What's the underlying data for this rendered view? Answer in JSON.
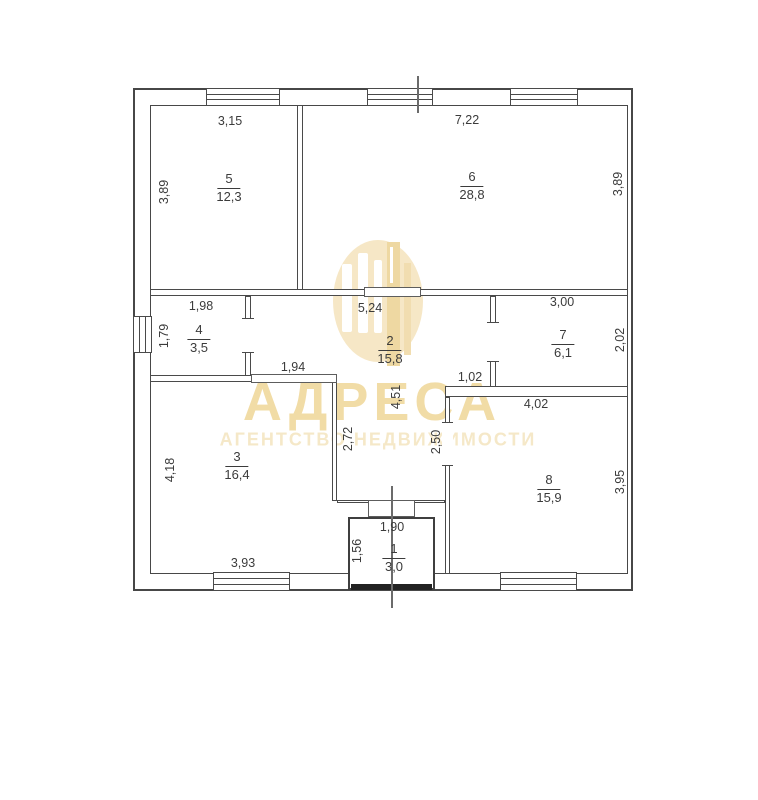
{
  "watermark": {
    "brand": "АДРЕСА",
    "tagline": "АГЕНТСТВО НЕДВИЖИМОСТИ",
    "brand_color": "#f1dca6",
    "tagline_color": "#f5e8c8",
    "logo_color": "#f6e7c6"
  },
  "colors": {
    "line": "#4a4a4a",
    "label": "#3b3b3b",
    "entrance_door": "#222222",
    "background": "#ffffff"
  },
  "rooms": {
    "r1": {
      "number": "1",
      "area": "3,0"
    },
    "r2": {
      "number": "2",
      "area": "15,8"
    },
    "r3": {
      "number": "3",
      "area": "16,4"
    },
    "r4": {
      "number": "4",
      "area": "3,5"
    },
    "r5": {
      "number": "5",
      "area": "12,3"
    },
    "r6": {
      "number": "6",
      "area": "28,8"
    },
    "r7": {
      "number": "7",
      "area": "6,1"
    },
    "r8": {
      "number": "8",
      "area": "15,9"
    }
  },
  "dims": {
    "room5_top": "3,15",
    "room6_top": "7,22",
    "room5_left": "3,89",
    "room6_right": "3,89",
    "room4_top": "1,98",
    "room4_left": "1,79",
    "hall_top": "5,24",
    "room7_top": "3,00",
    "room7_right": "2,02",
    "opening_hall_room3": "1,94",
    "passage_room8": "1,02",
    "room8_top": "4,02",
    "hall_height": "4,51",
    "corridor_left": "2,72",
    "corridor_right": "2,50",
    "room3_left": "4,18",
    "room3_bottom": "3,93",
    "room8_right": "3,95",
    "room1_top": "1,90",
    "room1_left": "1,56"
  }
}
